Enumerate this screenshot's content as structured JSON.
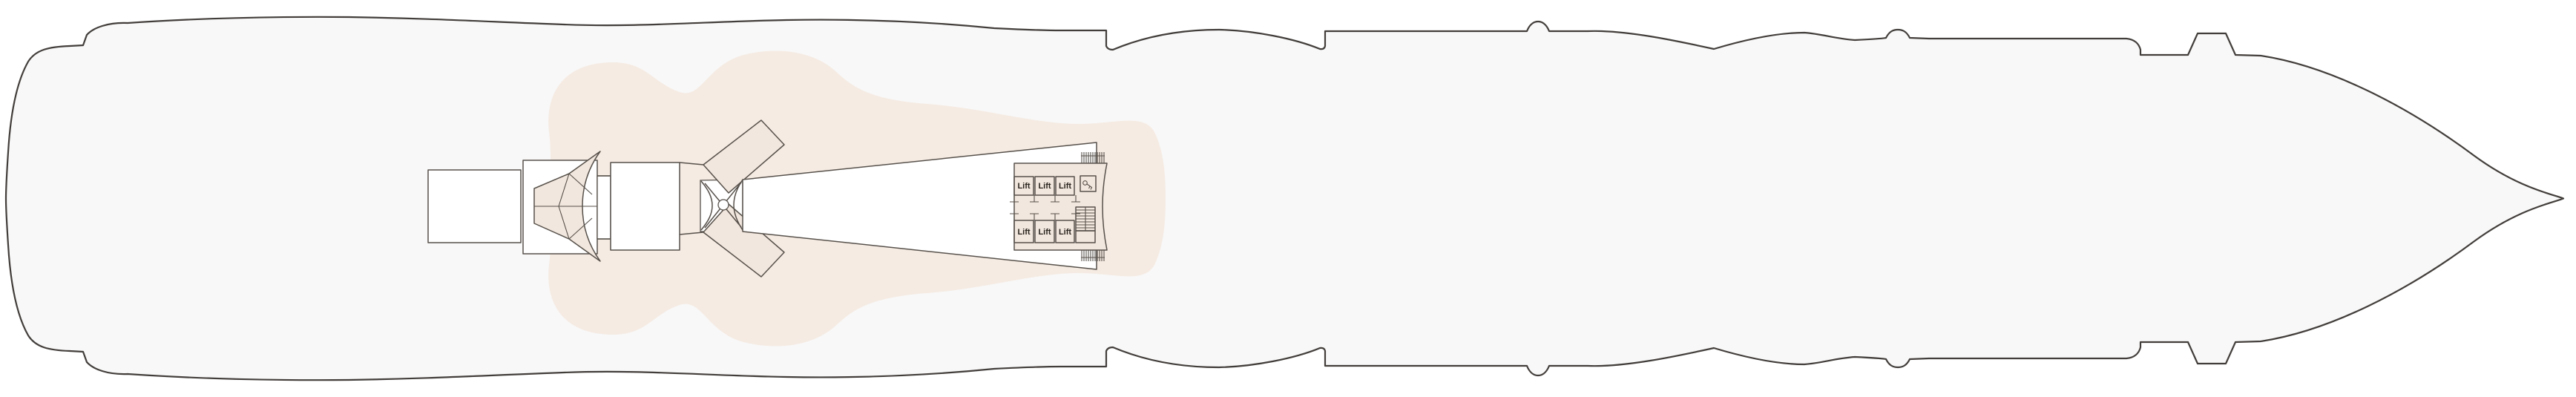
{
  "colors": {
    "page-bg": "#ffffff",
    "hull-fill": "#f8f8f8",
    "hull-stroke": "#423e3b",
    "tint-blob": "#f5ebe3",
    "tint-el": "#f2e7de",
    "line": "#57514b",
    "ink": "#29241f"
  },
  "ship": {
    "lift_labels": [
      "Lift",
      "Lift",
      "Lift",
      "Lift",
      "Lift",
      "Lift"
    ],
    "icons": {
      "utility_room": "key-icon",
      "stairs": "stairs-icon",
      "gangway_top": "gangway-hatch-icon",
      "gangway_bottom": "gangway-hatch-icon"
    }
  }
}
